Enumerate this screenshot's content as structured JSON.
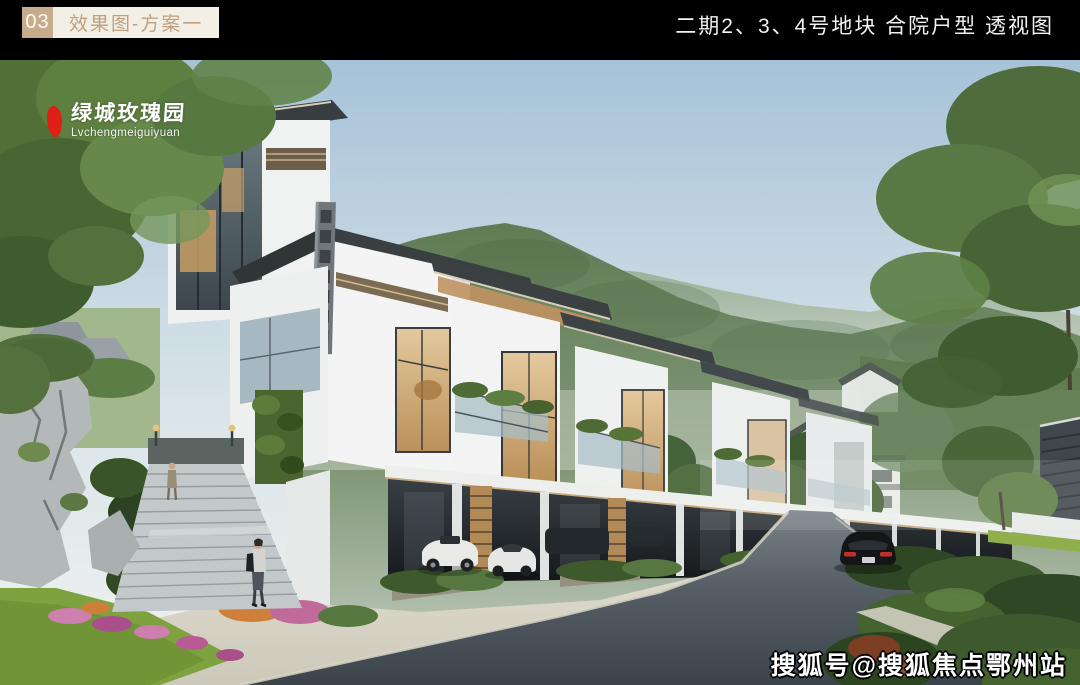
{
  "header": {
    "index_number": "03",
    "section_title": "效果图-方案一",
    "right_title": "二期2、3、4号地块  合院户型  透视图"
  },
  "logo": {
    "brand_cn": "绿城玫瑰园",
    "brand_en": "Lvchengmeiguiyuan"
  },
  "watermark": "搜狐号@搜狐焦点鄂州站",
  "colors": {
    "top_bar": "#000000",
    "badge_bg": "#c8ab8a",
    "label_bg": "#f4efe4",
    "label_text": "#bda184",
    "right_title_text": "#f2f2f2",
    "logo_red": "#e01f15",
    "logo_text": "#ffffff",
    "watermark_text": "#ffffff",
    "sky": "#a7c2d8",
    "mountain": "#5f7c54",
    "villa_wall": "#f2f3f2",
    "warm_window": "#d8b88a",
    "road": "#454d54",
    "grass": "#7da23f"
  }
}
